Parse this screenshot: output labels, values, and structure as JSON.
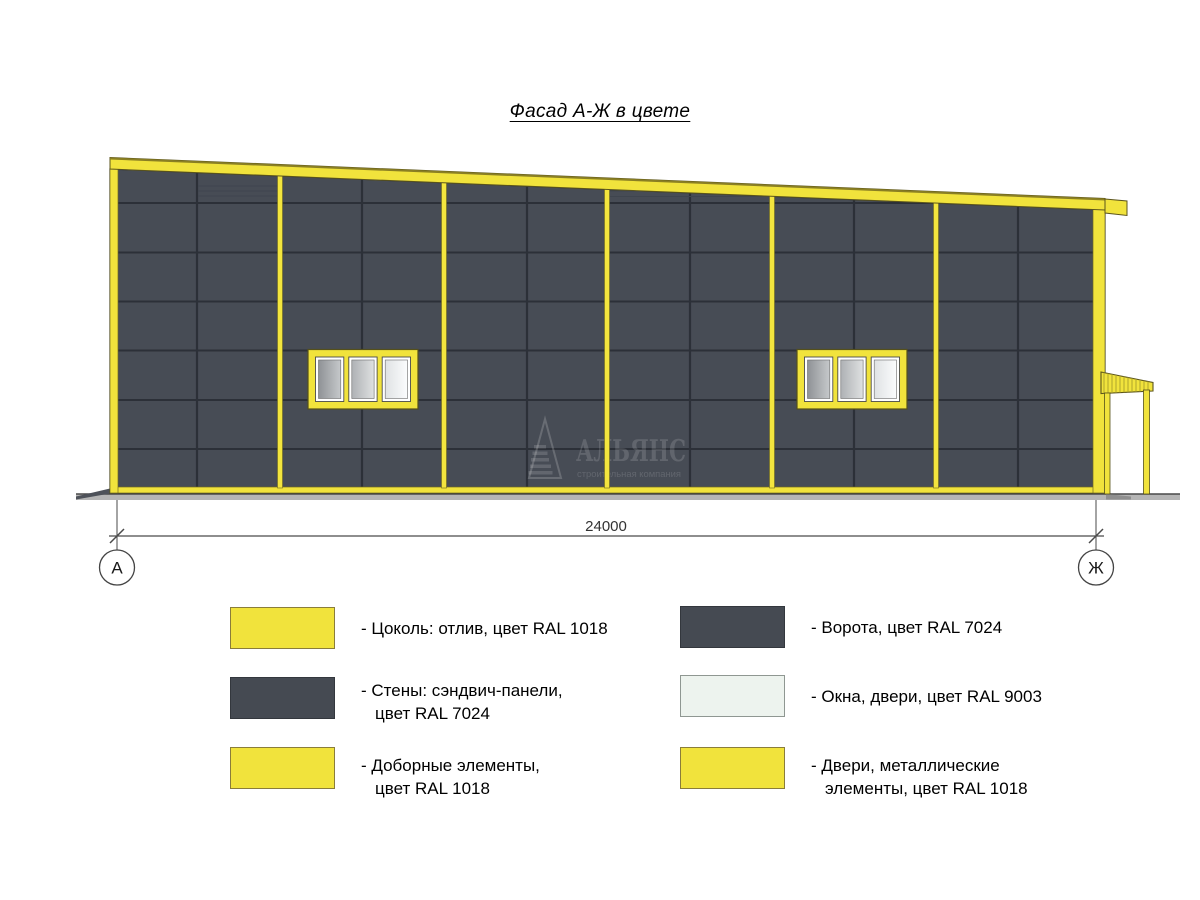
{
  "title": "Фасад А-Ж в цвете",
  "dimension": {
    "value": "24000"
  },
  "axes": {
    "left_label": "А",
    "right_label": "Ж"
  },
  "watermark": {
    "name": "АЛЬЯНС",
    "subtitle": "строительная компания"
  },
  "colors": {
    "ral1018_yellow": "#f1e33c",
    "ral7024_wall": "#474c55",
    "ral7024_swatch": "#454a52",
    "ral9003_window": "#edf3ee",
    "panel_joint": "#2c3038",
    "ground_gray": "#b5b5b5",
    "drawing_line": "#4a4a4a"
  },
  "legend": {
    "items": [
      {
        "swatch": "#f1e33c",
        "line1": "- Цоколь: отлив, цвет RAL 1018",
        "line2": ""
      },
      {
        "swatch": "#454a52",
        "line1": "- Стены: сэндвич-панели,",
        "line2": "цвет RAL 7024"
      },
      {
        "swatch": "#f1e33c",
        "line1": "- Доборные элементы,",
        "line2": "цвет RAL 1018"
      },
      {
        "swatch": "#454a52",
        "line1": "- Ворота, цвет RAL 7024",
        "line2": ""
      },
      {
        "swatch": "#edf3ee",
        "line1": "- Окна, двери, цвет RAL 9003",
        "line2": ""
      },
      {
        "swatch": "#f1e33c",
        "line1": "- Двери, металлические",
        "line2": "элементы, цвет RAL 1018"
      }
    ]
  }
}
